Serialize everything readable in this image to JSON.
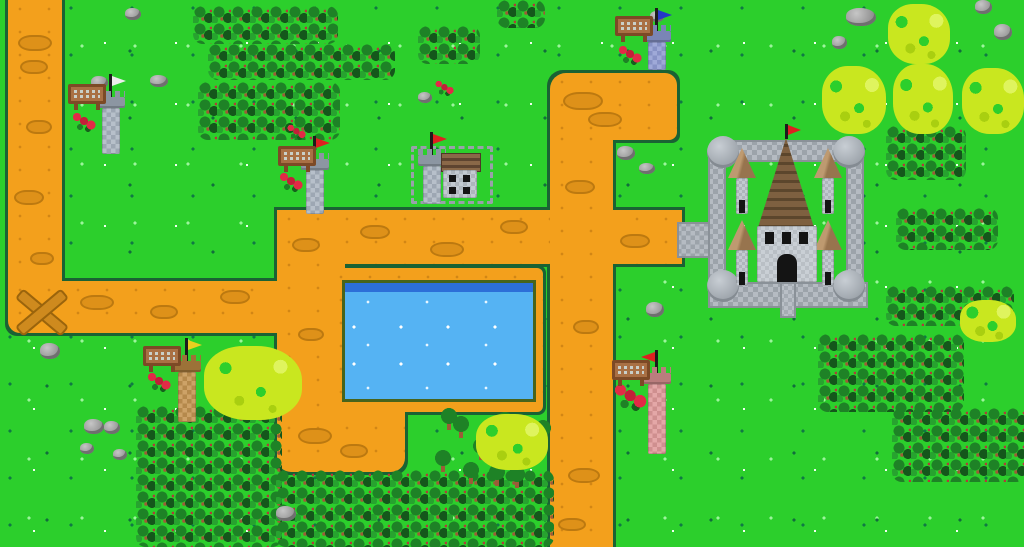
{
  "scene": {
    "type": "pixel-art tower-defense map",
    "width": 1024,
    "height": 547,
    "description": "Top-down grassland map with winding dirt paths, a rectangular pond, a walled stone castle with a brown-roofed keep and red flag, six flagged watch towers each with a wooden sign, forests, light-green bushes, rocks and red flowers."
  },
  "palette": {
    "grass": "#2CCF2C",
    "grass_speck_dark": "#0F7A44",
    "grass_speck_light": "#9CF59C",
    "path": "#F3A01C",
    "path_blotch": "#DE9119",
    "path_border": "#1A6234",
    "water": "#55B3F3",
    "water_deep": "#2C6FD8",
    "forest": "#1E8226",
    "bush": "#C9E71F",
    "rock": "#9F9F9F",
    "castle_stone": "#B5BBC2",
    "keep_roof": "#7E6040",
    "sign_wood": "#A97044",
    "flag_red": "#DF2020",
    "flag_blue": "#2438C8",
    "flag_yellow": "#E8D020",
    "flag_white": "#EDEDED",
    "flower_red": "#E22A46"
  },
  "paths": [
    {
      "id": "path-entry-left",
      "x": 8,
      "y": 0,
      "w": 54,
      "h": 290,
      "r": "0"
    },
    {
      "id": "path-left-horizontal",
      "x": 8,
      "y": 281,
      "w": 337,
      "h": 52,
      "r": "0 0 0 12px"
    },
    {
      "id": "path-center-vertical",
      "x": 277,
      "y": 210,
      "w": 68,
      "h": 200,
      "r": "0"
    },
    {
      "id": "path-pond-plaza",
      "x": 277,
      "y": 396,
      "w": 128,
      "h": 76,
      "r": "0 14px 14px 14px"
    },
    {
      "id": "path-middle-horizontal",
      "x": 277,
      "y": 210,
      "w": 405,
      "h": 54,
      "r": "0"
    },
    {
      "id": "path-top-horizontal",
      "x": 550,
      "y": 73,
      "w": 127,
      "h": 67,
      "r": "16px 12px 8px 0"
    },
    {
      "id": "path-right-vertical",
      "x": 550,
      "y": 130,
      "w": 63,
      "h": 417,
      "r": "0"
    }
  ],
  "path_x_mark": {
    "x": 12,
    "y": 282,
    "len": 56,
    "thick": 9
  },
  "path_blotches": [
    [
      18,
      35,
      30,
      12
    ],
    [
      20,
      60,
      24,
      10
    ],
    [
      26,
      120,
      22,
      10
    ],
    [
      14,
      190,
      26,
      11
    ],
    [
      30,
      252,
      20,
      9
    ],
    [
      80,
      295,
      30,
      11
    ],
    [
      150,
      305,
      24,
      10
    ],
    [
      220,
      290,
      26,
      10
    ],
    [
      292,
      238,
      24,
      10
    ],
    [
      298,
      328,
      22,
      9
    ],
    [
      298,
      428,
      30,
      12
    ],
    [
      340,
      444,
      24,
      10
    ],
    [
      360,
      225,
      26,
      10
    ],
    [
      430,
      242,
      30,
      11
    ],
    [
      500,
      220,
      24,
      10
    ],
    [
      620,
      234,
      26,
      10
    ],
    [
      563,
      92,
      36,
      14
    ],
    [
      588,
      112,
      30,
      11
    ],
    [
      565,
      180,
      26,
      10
    ],
    [
      573,
      320,
      22,
      10
    ],
    [
      568,
      468,
      28,
      11
    ],
    [
      558,
      518,
      24,
      9
    ]
  ],
  "pond": {
    "frame": [
      329,
      268,
      214,
      144
    ],
    "water": [
      345,
      283,
      188,
      116
    ],
    "deep_strip_h": 9
  },
  "bridge": [
    677,
    222,
    34,
    36
  ],
  "castle": {
    "x": 700,
    "y": 124,
    "walls": [
      [
        12,
        16,
        148,
        22
      ],
      [
        8,
        30,
        18,
        150
      ],
      [
        146,
        30,
        18,
        150
      ],
      [
        8,
        158,
        160,
        26
      ]
    ],
    "corner_towers": [
      [
        7,
        12,
        32,
        32
      ],
      [
        133,
        12,
        32,
        32
      ],
      [
        7,
        146,
        32,
        32
      ],
      [
        133,
        146,
        32,
        32
      ]
    ],
    "small_turrets": [
      [
        28,
        24
      ],
      [
        114,
        24
      ],
      [
        28,
        96
      ],
      [
        114,
        96
      ]
    ],
    "keep": {
      "roof": [
        54,
        14,
        64,
        90
      ],
      "body": [
        57,
        102,
        60,
        56
      ],
      "windows": [
        [
          8,
          6
        ],
        [
          25,
          6
        ],
        [
          42,
          6
        ]
      ],
      "door": [
        20,
        28,
        20,
        28
      ],
      "flag_color": "#DF2020"
    },
    "door_path": [
      80,
      158,
      16,
      36
    ]
  },
  "fort": {
    "fence": [
      411,
      146,
      82,
      58
    ],
    "house": {
      "x": 441,
      "y": 153,
      "roof": [
        0,
        0,
        38,
        17
      ],
      "body": [
        2,
        17,
        34,
        28
      ],
      "windows": [
        [
          6,
          5
        ],
        [
          20,
          5
        ],
        [
          6,
          17
        ],
        [
          20,
          17
        ]
      ]
    }
  },
  "turrets": [
    {
      "id": "turret-white-flag-nw",
      "x": 96,
      "y": 74,
      "body_h": 46,
      "c1": "#B7C0CA",
      "c2": "#9DA7B3",
      "cap": "#8C96A2",
      "flag": "#EDEDED",
      "dir": "right"
    },
    {
      "id": "turret-red-flag-mid",
      "x": 300,
      "y": 136,
      "body_h": 44,
      "c1": "#B7C0CA",
      "c2": "#9DA7B3",
      "cap": "#8C96A2",
      "flag": "#DF2020",
      "dir": "right"
    },
    {
      "id": "turret-fort",
      "x": 417,
      "y": 132,
      "body_h": 38,
      "c1": "#B7C0CA",
      "c2": "#9DA7B3",
      "cap": "#8C96A2",
      "flag": "#DF2020",
      "dir": "right"
    },
    {
      "id": "turret-blue-flag-top",
      "x": 642,
      "y": 8,
      "body_h": 28,
      "c1": "#9FA9D8",
      "c2": "#8792C6",
      "cap": "#7A85B5",
      "flag": "#2438C8",
      "dir": "right"
    },
    {
      "id": "turret-yellow-flag-sw",
      "x": 172,
      "y": 338,
      "body_h": 50,
      "c1": "#CDA267",
      "c2": "#B5894C",
      "cap": "#9C7238",
      "flag": "#E8D020",
      "dir": "right"
    },
    {
      "id": "turret-pink-south",
      "x": 642,
      "y": 350,
      "body_h": 70,
      "c1": "#E4A7A7",
      "c2": "#CF8F8F",
      "cap": "#BA7D7D",
      "flag": "#DF2020",
      "dir": "left"
    }
  ],
  "signs": [
    {
      "id": "sign-nw",
      "x": 68,
      "y": 84,
      "glyphs": "unreadable-pixel-text"
    },
    {
      "id": "sign-mid",
      "x": 278,
      "y": 146,
      "glyphs": "unreadable-pixel-text"
    },
    {
      "id": "sign-top",
      "x": 615,
      "y": 16,
      "glyphs": "unreadable-pixel-text"
    },
    {
      "id": "sign-sw",
      "x": 143,
      "y": 346,
      "glyphs": "unreadable-pixel-text"
    },
    {
      "id": "sign-south",
      "x": 612,
      "y": 360,
      "glyphs": "unreadable-pixel-text"
    }
  ],
  "forests": [
    [
      193,
      6,
      145,
      38
    ],
    [
      208,
      44,
      187,
      36
    ],
    [
      198,
      82,
      142,
      58
    ],
    [
      418,
      26,
      62,
      38
    ],
    [
      497,
      0,
      48,
      28
    ],
    [
      886,
      126,
      80,
      54
    ],
    [
      896,
      208,
      102,
      42
    ],
    [
      886,
      286,
      128,
      40
    ],
    [
      818,
      334,
      146,
      78
    ],
    [
      892,
      408,
      134,
      74
    ],
    [
      136,
      406,
      146,
      141
    ],
    [
      276,
      470,
      278,
      77
    ]
  ],
  "single_trees": [
    [
      434,
      450
    ],
    [
      452,
      416
    ],
    [
      472,
      438
    ],
    [
      496,
      412
    ],
    [
      516,
      446
    ],
    [
      534,
      420
    ],
    [
      462,
      462
    ],
    [
      488,
      464
    ],
    [
      508,
      466
    ],
    [
      440,
      408
    ]
  ],
  "bushes": [
    [
      888,
      4,
      62,
      60
    ],
    [
      822,
      66,
      64,
      68
    ],
    [
      893,
      64,
      60,
      70
    ],
    [
      962,
      68,
      62,
      66
    ],
    [
      960,
      300,
      56,
      42
    ],
    [
      204,
      346,
      98,
      74
    ],
    [
      476,
      414,
      72,
      56
    ]
  ],
  "rocks": [
    [
      846,
      8,
      30,
      18
    ],
    [
      975,
      0,
      17,
      14
    ],
    [
      994,
      24,
      18,
      16
    ],
    [
      832,
      36,
      15,
      13
    ],
    [
      125,
      8,
      16,
      12
    ],
    [
      650,
      11,
      14,
      11
    ],
    [
      91,
      76,
      17,
      13
    ],
    [
      150,
      75,
      18,
      12
    ],
    [
      418,
      92,
      14,
      11
    ],
    [
      617,
      146,
      18,
      14
    ],
    [
      639,
      163,
      16,
      11
    ],
    [
      646,
      302,
      18,
      15
    ],
    [
      40,
      343,
      20,
      16
    ],
    [
      84,
      419,
      20,
      15
    ],
    [
      104,
      421,
      16,
      13
    ],
    [
      80,
      443,
      14,
      11
    ],
    [
      113,
      449,
      14,
      11
    ],
    [
      276,
      506,
      20,
      15
    ]
  ],
  "flowers": [
    {
      "x": 71,
      "y": 112,
      "s": 1
    },
    {
      "x": 278,
      "y": 172,
      "s": 1
    },
    {
      "x": 617,
      "y": 45,
      "s": 1
    },
    {
      "x": 146,
      "y": 372,
      "s": 1
    },
    {
      "x": 612,
      "y": 383,
      "s": 1.4
    },
    {
      "x": 286,
      "y": 124,
      "s": 0.8
    },
    {
      "x": 434,
      "y": 80,
      "s": 0.8
    }
  ]
}
